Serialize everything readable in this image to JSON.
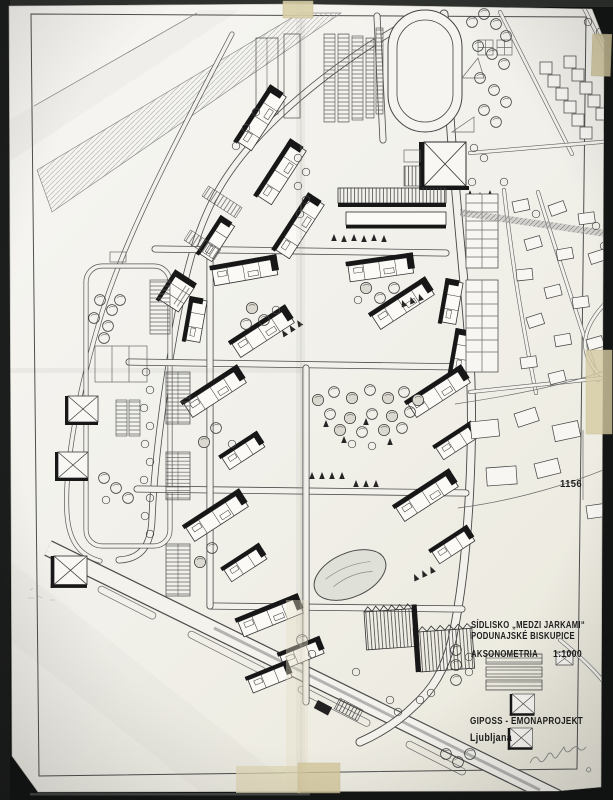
{
  "document": {
    "archive_number": "1156",
    "title_block": {
      "line1": "SÍDLISKO „MEDZI JARKAMI“",
      "line2": "PODUNAJSKÉ BISKUPICE",
      "drawing_type": "AKSONOMETRIA",
      "scale": "1:1000"
    },
    "firm_block": {
      "firm": "GIPOSS - EMONAPROJEKT",
      "city": "Ljubljana"
    }
  },
  "colors": {
    "backdrop": "#141615",
    "paper": "#f2f1ec",
    "ink": "#3c3c3c",
    "shadow_ink": "#171717",
    "tape": "#d9cda5"
  }
}
